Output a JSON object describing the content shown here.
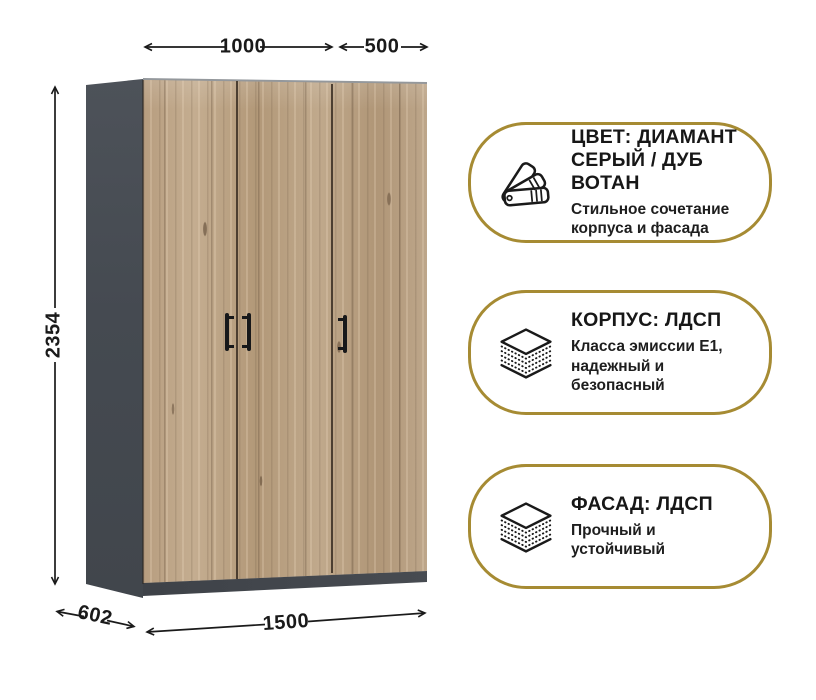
{
  "product": {
    "type": "three-door-wardrobe",
    "dimensions": {
      "top_width_mm": "1000",
      "top_door_mm": "500",
      "height_mm": "2354",
      "width_mm": "1500",
      "depth_mm": "602"
    },
    "colors": {
      "carcass_gray": "#454A51",
      "plinth_gray": "#3E4248",
      "door_wood_base": "#B79E81",
      "door_wood_light": "#C4AD90",
      "handle_black": "#17181A"
    }
  },
  "badges": [
    {
      "icon": "color-swatches-icon",
      "title": "ЦВЕТ: ДИАМАНТ\nСЕРЫЙ / ДУБ ВОТАН",
      "subtitle": "Стильное сочетание\nкорпуса и фасада"
    },
    {
      "icon": "layers-icon",
      "title": "КОРПУС: ЛДСП",
      "subtitle": "Класса эмиссии Е1,\nнадежный и\nбезопасный"
    },
    {
      "icon": "layers-icon",
      "title": "ФАСАД: ЛДСП",
      "subtitle": "Прочный и\nустойчивый"
    }
  ],
  "style": {
    "accent_gold": "#A68B33",
    "text_color": "#1B1B1B",
    "background": "#FFFFFF"
  }
}
